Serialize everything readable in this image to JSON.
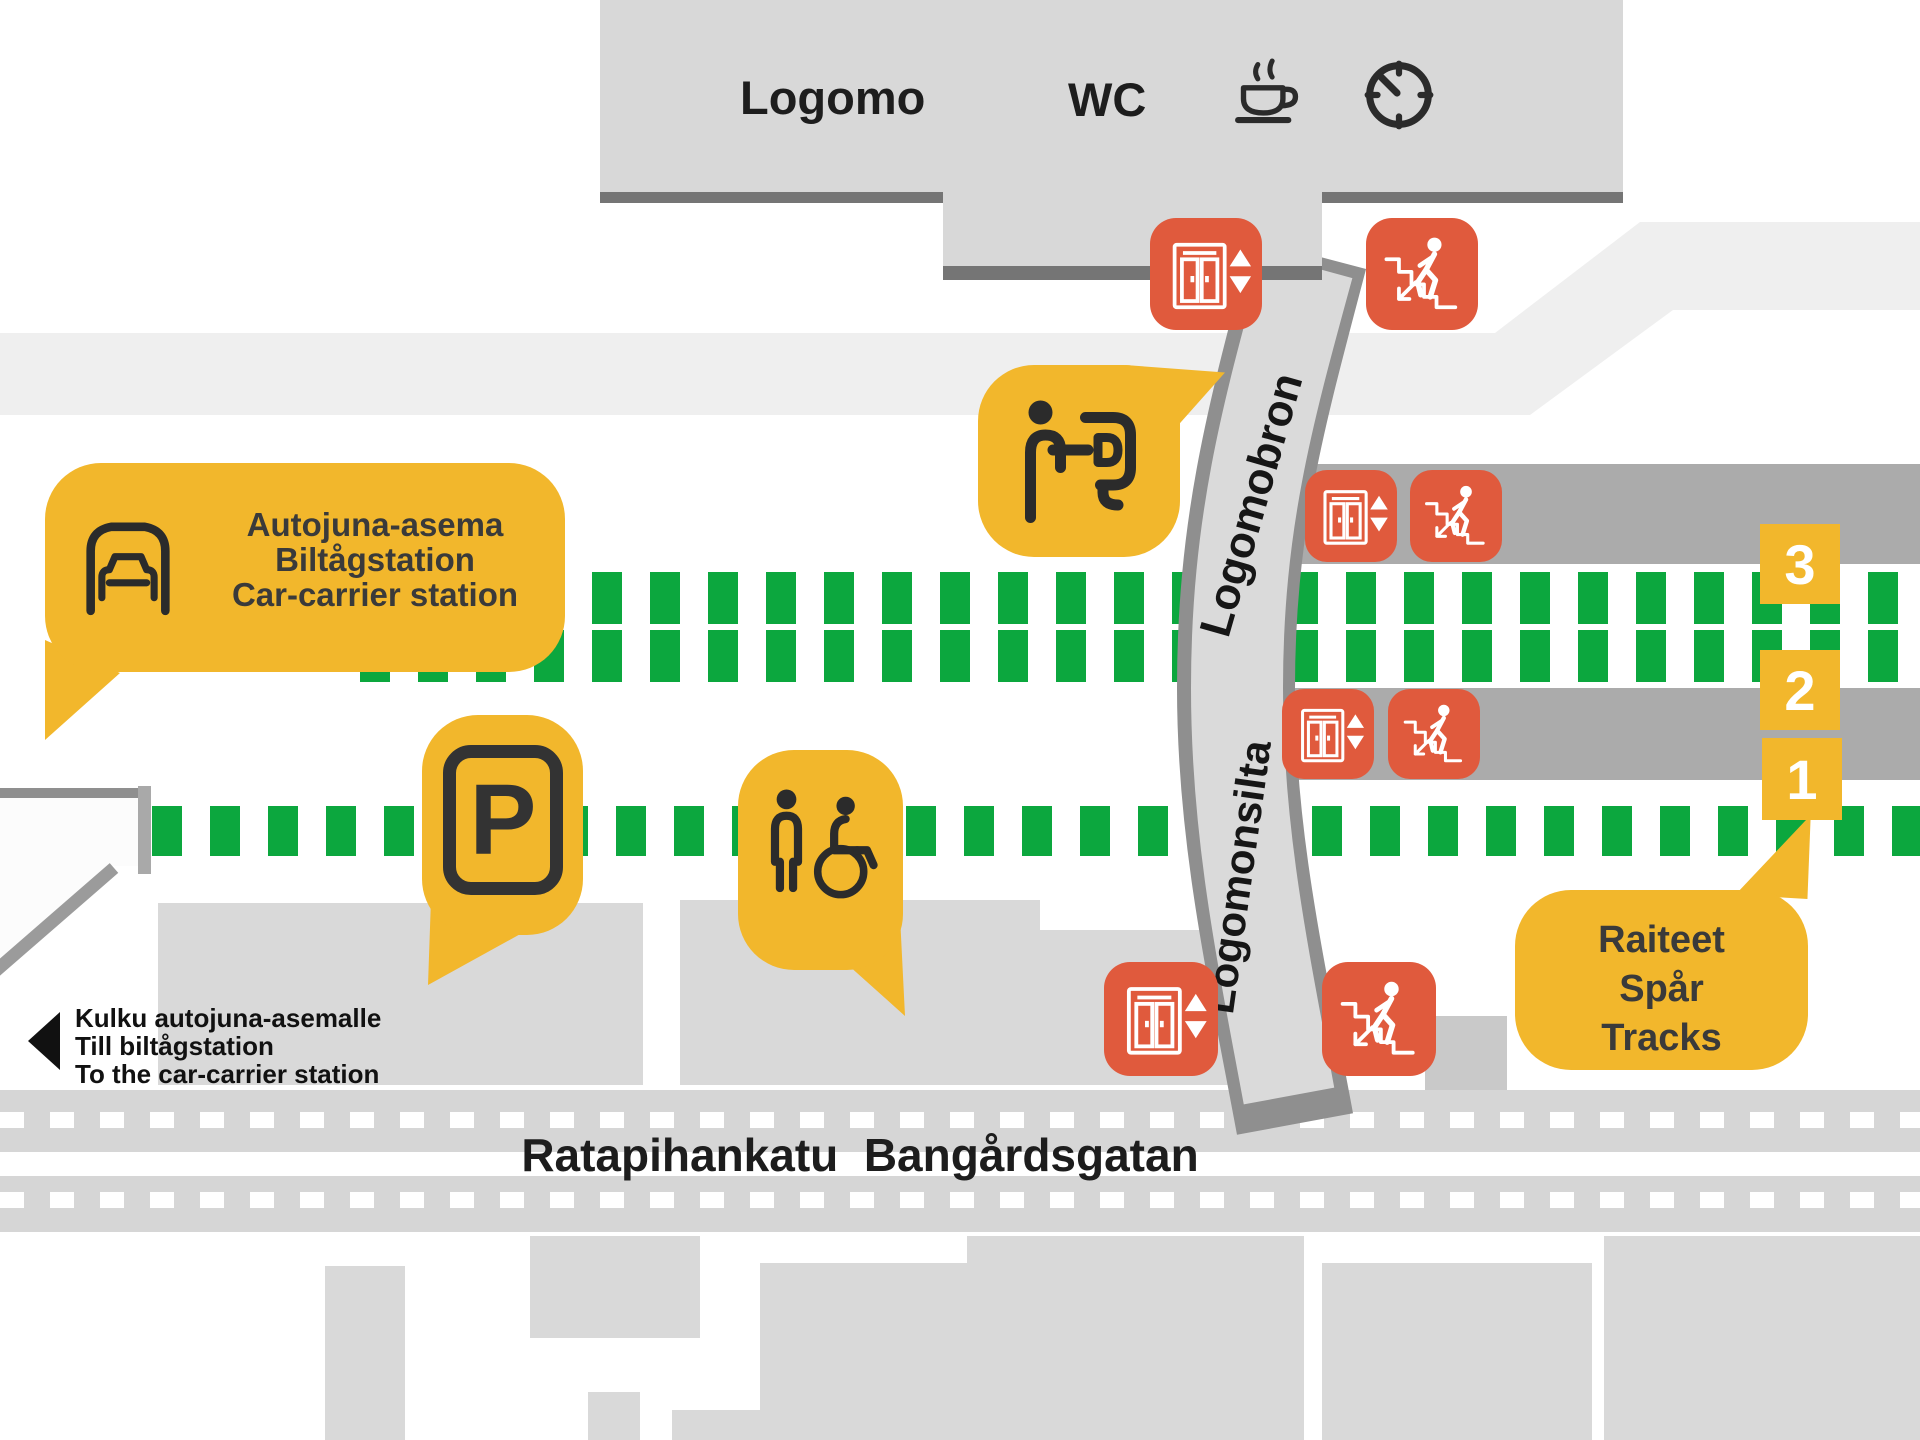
{
  "colors": {
    "yellow": "#F2B72C",
    "orange": "#E05A3D",
    "green": "#0CA73E",
    "plat": "#ABABAB",
    "bld": "#D8D8D8",
    "bld_edge": "#757575",
    "bridge_fill": "#DADADA",
    "bridge_edge": "#8F8F8F",
    "faint": "#EFEFEF",
    "street": "#D6D6D6",
    "blocks": "#D9D9D9",
    "ink": "#2B2B2B"
  },
  "building": {
    "label": "Logomo",
    "wc_label": "WC",
    "amenity_icons": [
      "wc-label",
      "coffee-cup-icon",
      "clock-icon"
    ]
  },
  "bridge": {
    "upper_label": "Logomobron",
    "lower_label": "Logomonsilta"
  },
  "street": {
    "name_fi": "Ratapihankatu",
    "name_sv": "Bangårdsgatan",
    "separator": "  "
  },
  "bubbles": {
    "car_carrier": {
      "icon": "car-carrier-icon",
      "lines": [
        "Autojuna-asema",
        "Biltågstation",
        "Car-carrier station"
      ]
    },
    "info": {
      "icon": "info-desk-icon"
    },
    "parking": {
      "label": "P",
      "icon": "parking-sign-icon"
    },
    "accessible_wc": {
      "icon": "accessible-toilet-icon"
    },
    "tracks": {
      "lines": [
        "Raiteet",
        "Spår",
        "Tracks"
      ]
    }
  },
  "track_badges": [
    {
      "label": "3"
    },
    {
      "label": "2"
    },
    {
      "label": "1"
    }
  ],
  "access_note": {
    "icon": "arrow-left-icon",
    "lines": [
      "Kulku autojuna-asemalle",
      "Till biltågstation",
      "To the car-carrier station"
    ]
  },
  "facility_icons": {
    "elevator": "elevator-icon",
    "stairs": "stairs-icon",
    "count_elevators": 4,
    "count_stairs": 4
  }
}
